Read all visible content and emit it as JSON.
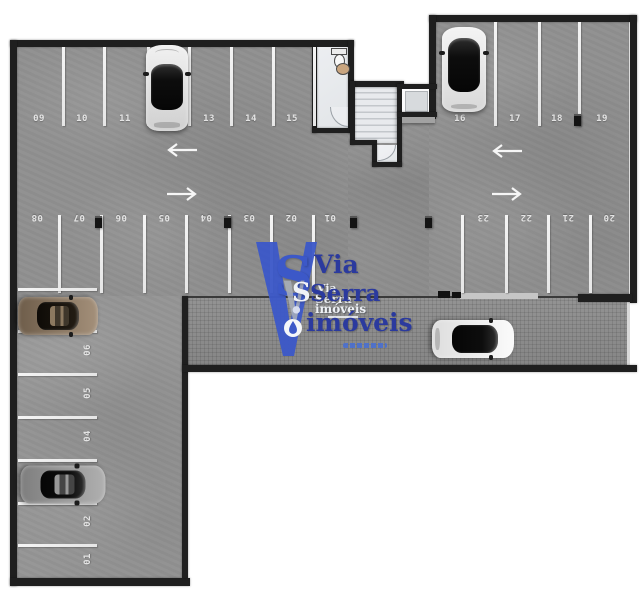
{
  "plan": {
    "kind": "parking-garage-floor-plan",
    "colors": {
      "background": "#ffffff",
      "floor": "#909090",
      "road": "#8d8d8d",
      "wall": "#1f1f1f",
      "parking_line": "#f2f2f2",
      "room_floor": "#e9ebee",
      "logo_blue": "#3c58c8",
      "logo_navy": "#2b3a9e"
    }
  },
  "rows": {
    "top_left": {
      "labels": [
        "09",
        "10",
        "11",
        "12",
        "13",
        "14",
        "15"
      ]
    },
    "top_right": {
      "labels": [
        "16",
        "17",
        "18",
        "19"
      ]
    },
    "mid_left": {
      "labels": [
        "08",
        "07",
        "06",
        "05",
        "04",
        "03",
        "02",
        "01"
      ]
    },
    "mid_right": {
      "labels": [
        "23",
        "22",
        "21",
        "20"
      ]
    },
    "left_col": {
      "labels": [
        "07",
        "06",
        "05",
        "04",
        "03",
        "02",
        "01"
      ]
    }
  },
  "logo": {
    "monogram_v": "V",
    "monogram_s": "S",
    "line1": "Via",
    "line2": "Serra",
    "line3": "imóveis",
    "ghost_line1": "Via",
    "ghost_line2": "Serra",
    "ghost_line3": "imóveis"
  },
  "cars": [
    {
      "space": "12",
      "color": "silver",
      "facing": "up"
    },
    {
      "space": "16",
      "color": "white-black-top",
      "facing": "up"
    },
    {
      "space": "07",
      "color": "bronze",
      "facing": "right"
    },
    {
      "space": "03",
      "color": "gray",
      "facing": "right"
    },
    {
      "space": "driveway",
      "color": "white-black-roof",
      "facing": "right"
    }
  ]
}
